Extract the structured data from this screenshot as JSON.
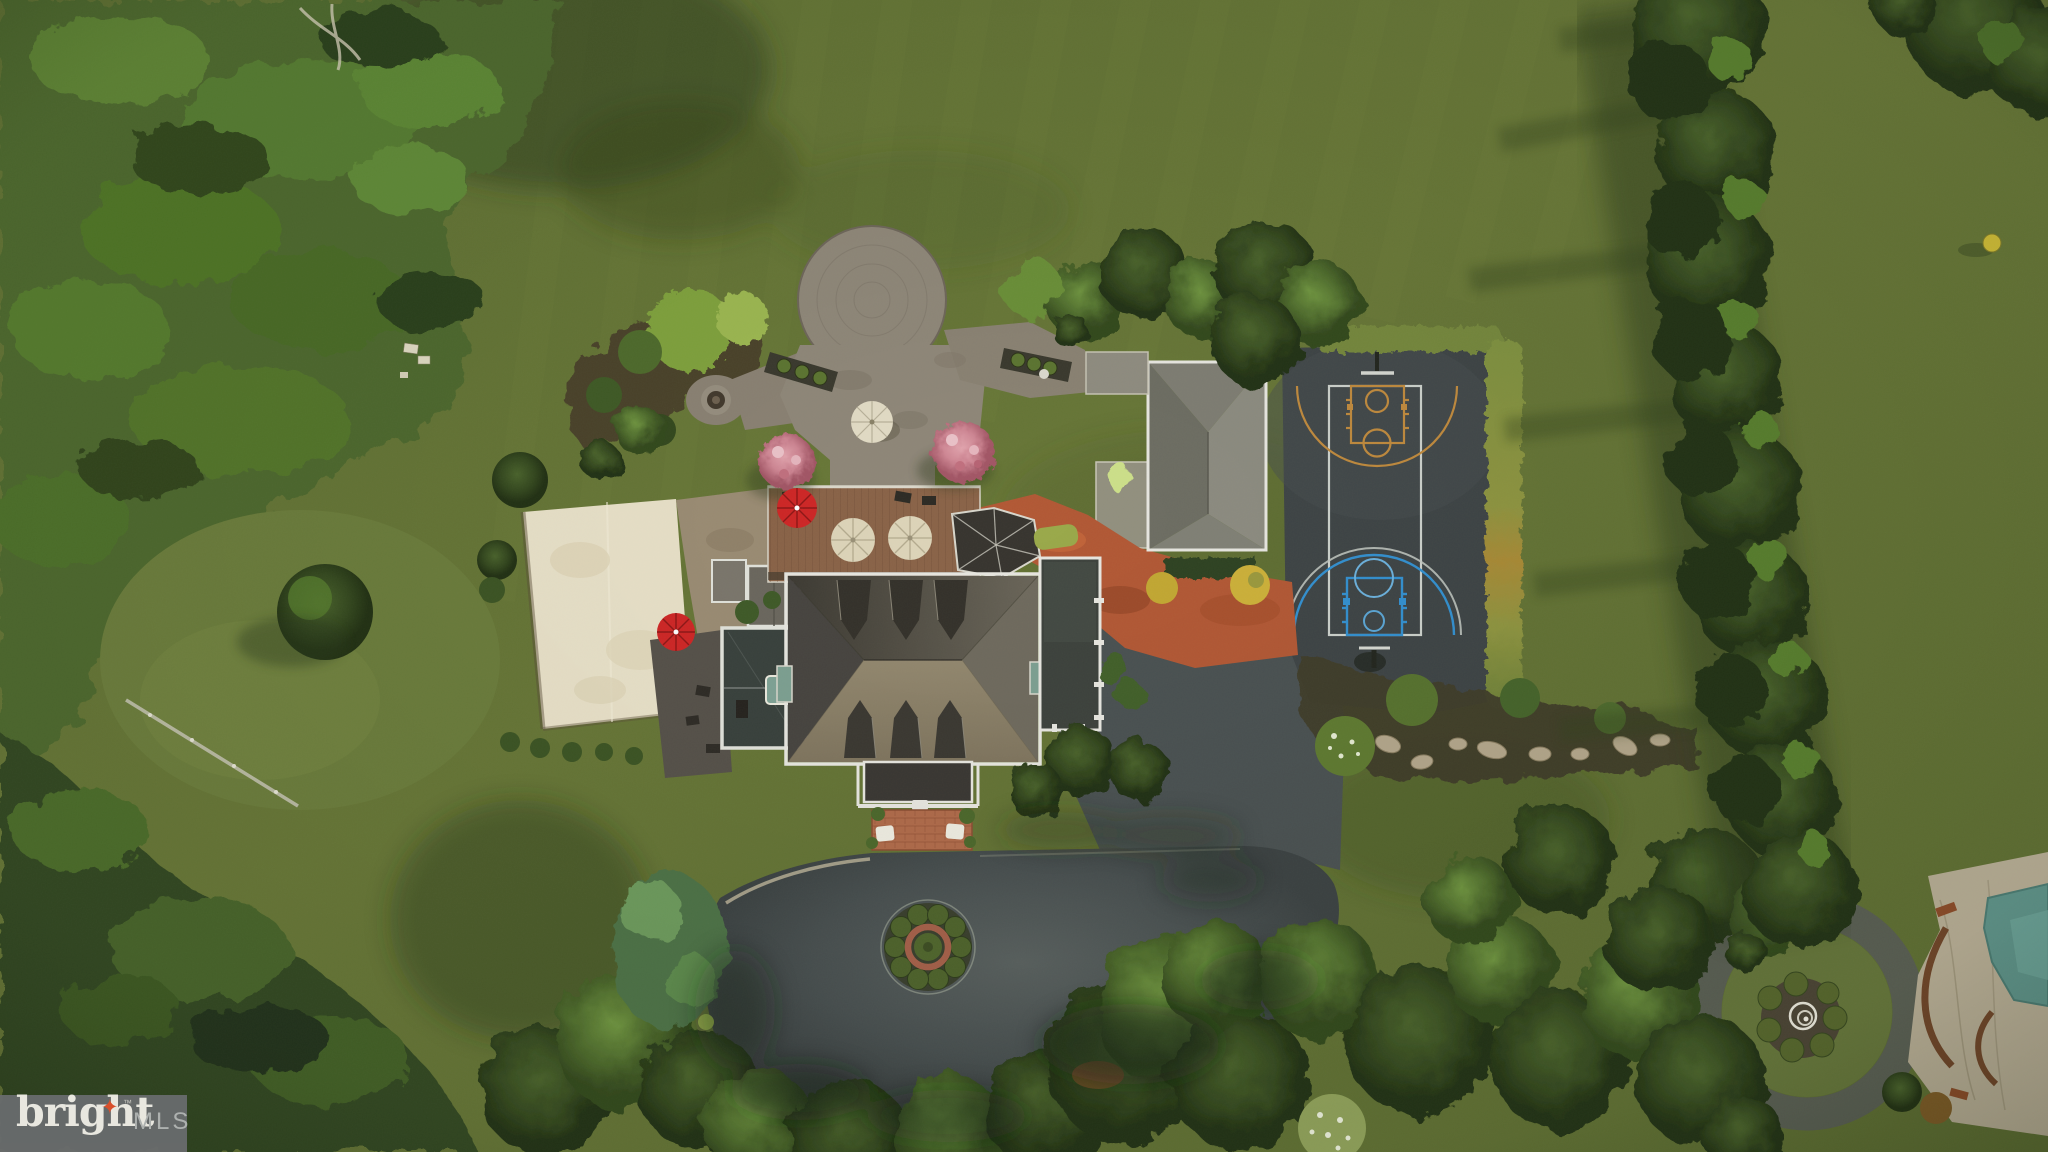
{
  "image": {
    "kind": "aerial-drone-photo",
    "width": 2048,
    "height": 1152,
    "description": "Overhead drone photograph of a wooded luxury estate: hip-roof mansion with dormers, stone patio with fire pit, wood deck with umbrellas, sand volleyball court, detached garage, basketball court with orange and blue keys, large asphalt court with circular planter, neighboring fountain circle and pool patio"
  },
  "watermark": {
    "brand": "bright",
    "star_glyph": "✦",
    "trademark": "™",
    "suffix": "MLS",
    "panel_color": "#696c6e",
    "brand_color": "#f3f0ea",
    "suffix_color": "#b4b7b8",
    "star_color": "#e2512e"
  },
  "palette": {
    "lawn": "#64743a",
    "forest_dark": "#324722",
    "forest_light": "#5e8434",
    "asphalt": "#474e50",
    "court_asphalt": "#3e4446",
    "court_line_white": "#ccd1cc",
    "court_line_orange": "#c08a3e",
    "court_line_blue": "#3390d0",
    "sand": "#e9e1c9",
    "roof_dark": "#3f3c35",
    "roof_light": "#8f8573",
    "white_trim": "#e8e7e1",
    "deck_wood": "#8a6348",
    "stone_patio": "#8f8779",
    "brick": "#b06b4b",
    "terracotta_paving": "#b25835",
    "red_umbrella": "#cf2626",
    "cream_umbrella": "#ded5ba",
    "pink_tree": "#cf8694",
    "pool_water": "#5d9188"
  },
  "scene": {
    "features": [
      {
        "name": "forest-top-left",
        "color": "#4d682f"
      },
      {
        "name": "forest-bottom-left",
        "color": "#324722"
      },
      {
        "name": "conifer-row-right",
        "color": "#33491f"
      },
      {
        "name": "main-house-hip-roof",
        "color": "#8f8573"
      },
      {
        "name": "roof-dormers",
        "count": 6
      },
      {
        "name": "teal-skylights",
        "count": 2
      },
      {
        "name": "wood-deck",
        "color": "#8a6348"
      },
      {
        "name": "white-patio-umbrellas",
        "count": 3
      },
      {
        "name": "red-umbrellas",
        "count": 2
      },
      {
        "name": "stone-patio-circle-with-fire-pit",
        "color": "#8f8779"
      },
      {
        "name": "pink-flowering-trees",
        "count": 2
      },
      {
        "name": "sand-volleyball-court",
        "color": "#e9e1c9"
      },
      {
        "name": "screened-porch",
        "color": "#39413d"
      },
      {
        "name": "front-porch-brick-walk-benches",
        "color": "#b06b4b"
      },
      {
        "name": "detached-garage",
        "color": "#8c8b80"
      },
      {
        "name": "terracotta-courtyard-paving",
        "color": "#b25835"
      },
      {
        "name": "basketball-court-orange-and-blue",
        "color": "#3e4446"
      },
      {
        "name": "landscape-bed-with-boulders",
        "color": "#413c2b"
      },
      {
        "name": "circular-driveway-planter",
        "color": "#4e632c"
      },
      {
        "name": "neighbor-fountain-circle",
        "color": "#585d52"
      },
      {
        "name": "pool-patio-corner",
        "color": "#b5ab93"
      },
      {
        "name": "bright-mls-watermark",
        "color": "#696c6e"
      }
    ]
  }
}
